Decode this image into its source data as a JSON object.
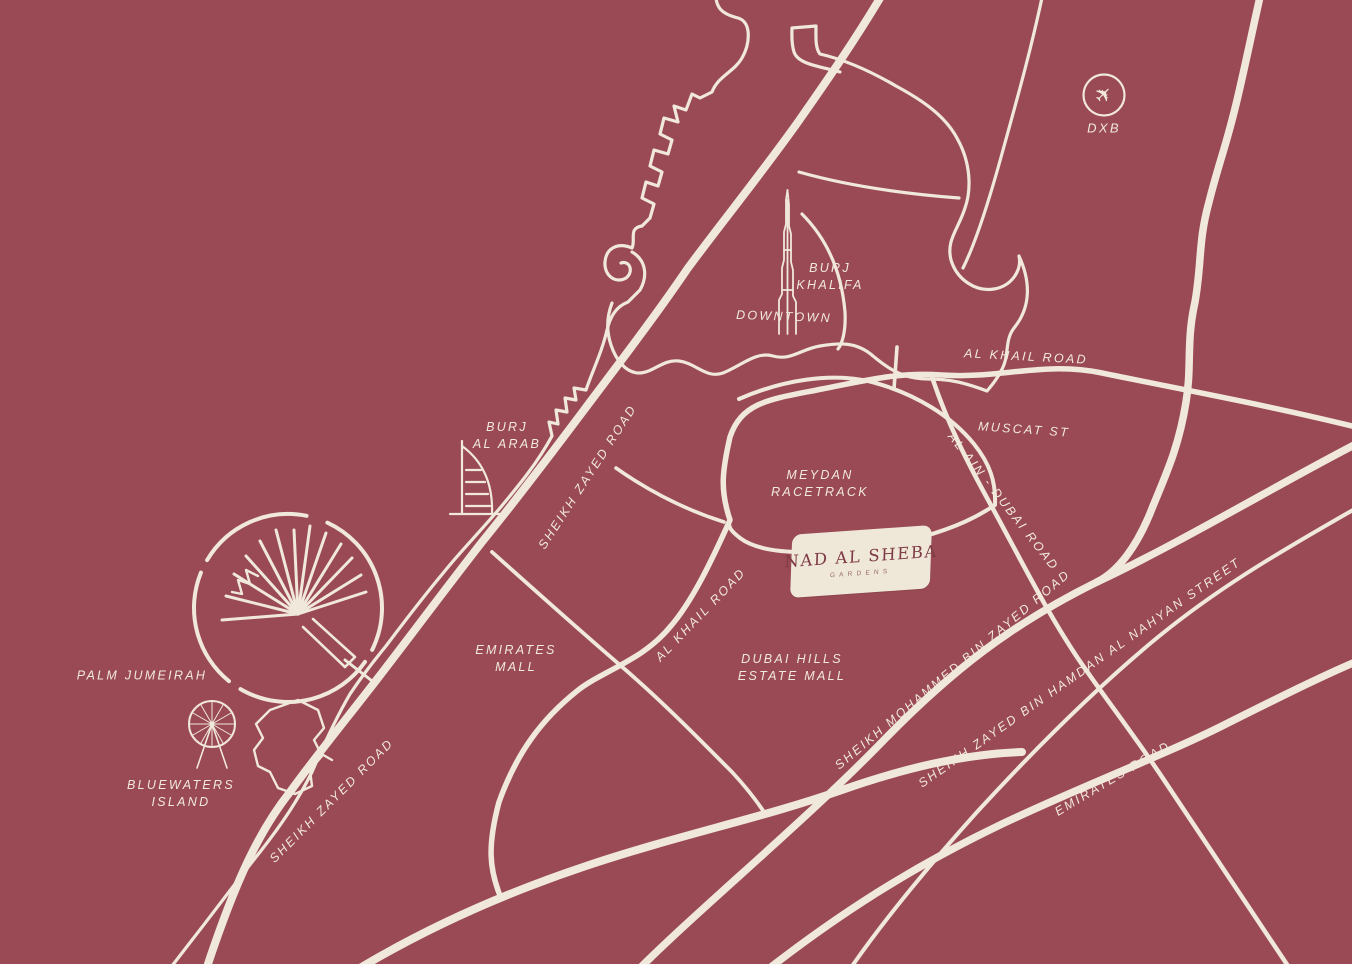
{
  "colors": {
    "background": "#9A4A54",
    "road": "#F0E8DA",
    "label_text": "#F1E9DB",
    "badge_background": "#EFE8D9",
    "badge_text": "#7E3A45"
  },
  "badge": {
    "title": "NAD AL SHEBA",
    "subtitle": "GARDENS"
  },
  "airport": {
    "code": "DXB",
    "glyph": "✈"
  },
  "labels": {
    "burj_khalifa": {
      "l1": "BURJ",
      "l2": "KHALIFA"
    },
    "downtown": "DOWNTOWN",
    "al_khail_road_top": "AL KHAIL ROAD",
    "muscat_st": "MUSCAT ST",
    "al_ain_dubai_road": "AL AIN - DUBAI ROAD",
    "meydan_racetrack": {
      "l1": "MEYDAN",
      "l2": "RACETRACK"
    },
    "sheikh_zayed_road_upper": "SHEIKH ZAYED ROAD",
    "burj_al_arab": {
      "l1": "BURJ",
      "l2": "AL ARAB"
    },
    "emirates_mall": {
      "l1": "EMIRATES",
      "l2": "MALL"
    },
    "al_khail_road_mid": "AL KHAIL ROAD",
    "dubai_hills_estate_mall": {
      "l1": "DUBAI HILLS",
      "l2": "ESTATE MALL"
    },
    "sheikh_mohammed_bin_zayed_road": "SHEIKH MOHAMMED BIN ZAYED ROAD",
    "sheikh_zayed_bin_hamdan": "SHEIKH ZAYED BIN HAMDAN AL NAHYAN STREET",
    "emirates_road": "EMIRATES ROAD",
    "palm_jumeirah": "PALM JUMEIRAH",
    "bluewaters_island": {
      "l1": "BLUEWATERS",
      "l2": "ISLAND"
    },
    "sheikh_zayed_road_lower": "SHEIKH ZAYED ROAD"
  }
}
